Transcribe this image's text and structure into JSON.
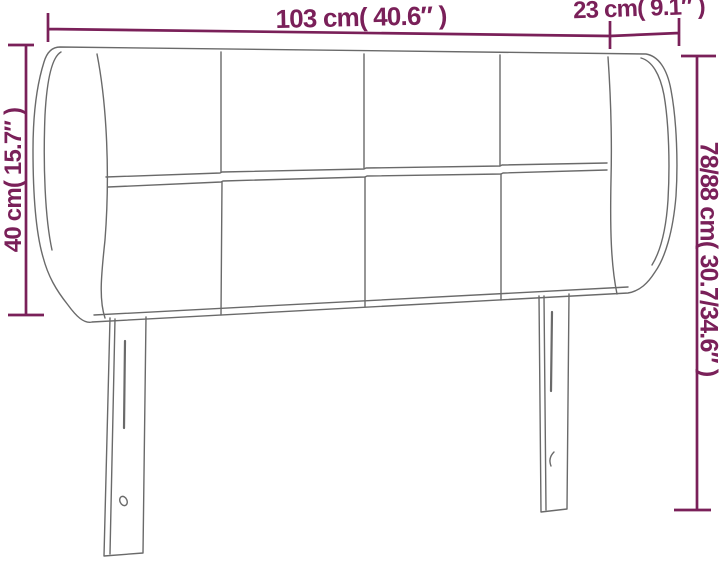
{
  "diagram": {
    "title": "Headboard dimension diagram",
    "colors": {
      "dimension_annotation": "#7a2059",
      "line_art": "#6a6a6a",
      "background": "#ffffff"
    },
    "labels": {
      "width_top": "103 cm( 40.6″ )",
      "wing_width": "23 cm( 9.1″ )",
      "height_left": "40 cm( 15.7″ )",
      "height_right": "78/88 cm( 30.7/34.6″ )"
    },
    "measurements": [
      {
        "name": "overall-width",
        "cm": "103",
        "inches": "40.6"
      },
      {
        "name": "wing-depth",
        "cm": "23",
        "inches": "9.1"
      },
      {
        "name": "headboard-panel-height",
        "cm": "40",
        "inches": "15.7"
      },
      {
        "name": "total-height-range",
        "cm": "78/88",
        "inches": "30.7/34.6"
      }
    ]
  }
}
